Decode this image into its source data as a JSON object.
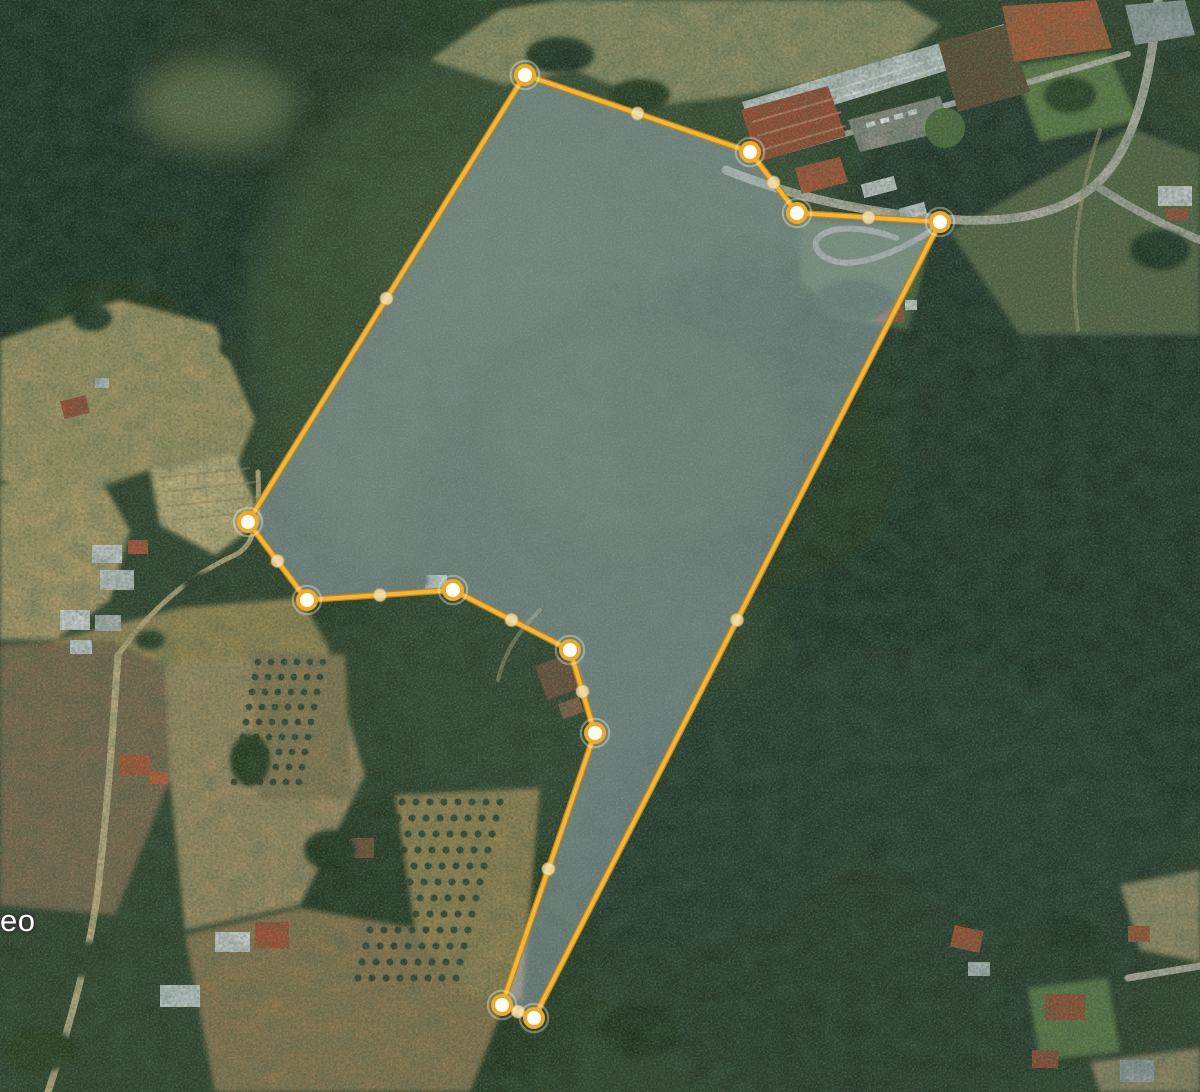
{
  "map": {
    "view_type": "satellite",
    "label_fragment": "eo",
    "label_color": "#ffffff"
  },
  "polygon": {
    "name": "measured-parcel",
    "fill_color": "rgba(173,190,202,0.45)",
    "stroke_color": "#F1B63F",
    "stroke_outer_color": "#C08516",
    "stroke_width": 4,
    "vertices": [
      [
        525,
        75
      ],
      [
        750,
        152
      ],
      [
        797,
        213
      ],
      [
        940,
        222
      ],
      [
        534,
        1018
      ],
      [
        502,
        1005
      ],
      [
        595,
        733
      ],
      [
        570,
        650
      ],
      [
        453,
        590
      ],
      [
        307,
        600
      ],
      [
        248,
        522
      ]
    ],
    "vertex_marker": {
      "radius": 9,
      "fill": "#FFFDF4",
      "ring_color": "#EDA92E",
      "ring_width": 4,
      "halo_color": "rgba(255,248,220,0.35)"
    },
    "midpoint_marker": {
      "radius": 6.5,
      "fill": "#F4E4B8",
      "opacity": 0.82,
      "ring_color": "rgba(214,164,60,0.55)",
      "ring_width": 1.5
    }
  }
}
